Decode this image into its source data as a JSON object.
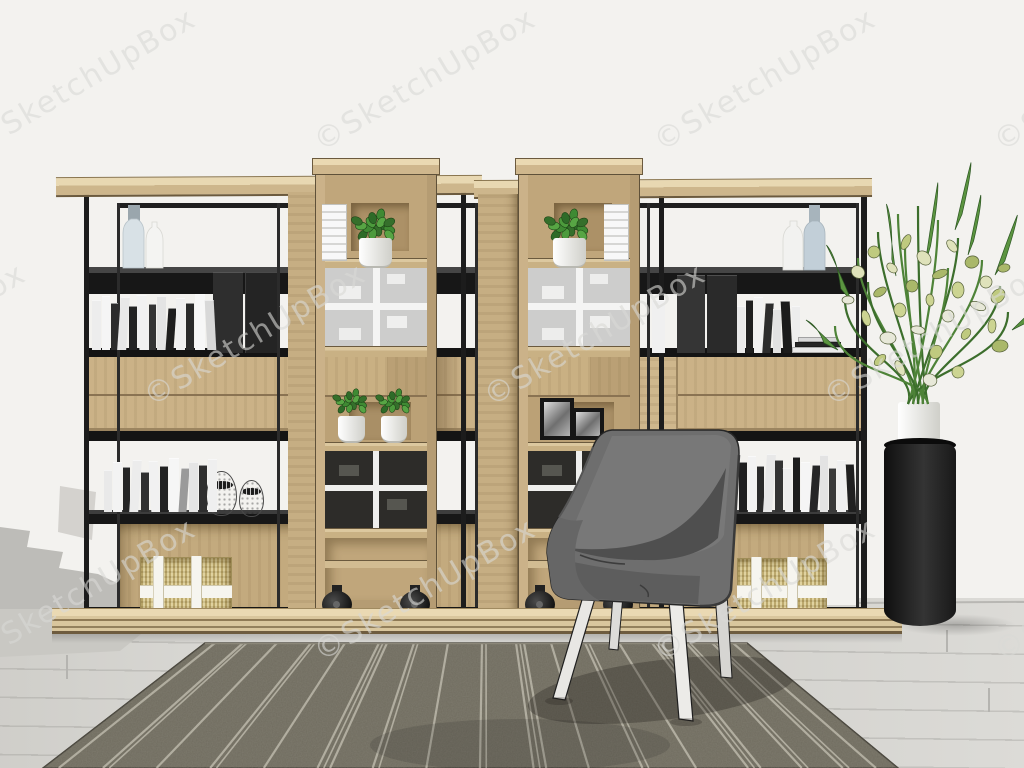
{
  "image_type": "3d-render-screenshot",
  "scene": {
    "description": "Modern home office corner: large open metal-and-wood shelving unit with two rolling wooden tower cabinets, grey fabric armchair, striped rug, flower arrangement on black pedestal",
    "objects": [
      "shelving-unit",
      "rolling-tower-left",
      "rolling-tower-right",
      "armchair",
      "striped-rug",
      "flower-pedestal",
      "books",
      "storage-baskets",
      "decor-vases",
      "potted-plants",
      "photo-frames",
      "egg-ornaments",
      "wood-floor",
      "white-wall"
    ]
  },
  "watermark": {
    "text": "©SketchUpBox",
    "angle_deg": -30.5,
    "font_size": 30,
    "rows": [
      {
        "y": 80,
        "xs": [
          85,
          425,
          765,
          1105
        ]
      },
      {
        "y": 335,
        "xs": [
          -85,
          255,
          595,
          935
        ]
      },
      {
        "y": 590,
        "xs": [
          85,
          425,
          765,
          1105
        ]
      }
    ]
  },
  "colors": {
    "wall": "#f3f2ef",
    "floor": "#dad9d5",
    "wood_light": "#cbb289",
    "wood_top": "#e8d8b4",
    "wood_dark": "#b59c73",
    "metal_frame": "#1c1c1c",
    "rug_base": "#6f6b5e",
    "rug_stripe": "#c9c5b6",
    "chair_fabric": "#6e6e6e",
    "pedestal": "#1a1a1a",
    "plant_green": "#4e8338",
    "blossom": "#dfe2bb",
    "basket_straw": "#d5c387"
  },
  "shelf": {
    "book_rows": [
      {
        "x": 92,
        "base": 350,
        "spines": [
          [
            9,
            50,
            "#ededed"
          ],
          [
            8,
            54,
            "#f5f5f5"
          ],
          [
            7,
            47,
            "#2b2b2b"
          ],
          [
            9,
            53,
            "#e8e8e8"
          ],
          [
            8,
            44,
            "#232323"
          ],
          [
            10,
            55,
            "#f1f1f1"
          ],
          [
            7,
            46,
            "#343434"
          ],
          [
            9,
            54,
            "#e4e4e4"
          ],
          [
            8,
            42,
            "#1e1e1e"
          ],
          [
            9,
            52,
            "#f0f0f0"
          ],
          [
            8,
            47,
            "#2a2a2a"
          ],
          [
            10,
            56,
            "#f7f7f7"
          ],
          [
            9,
            50,
            "#d8d8d8"
          ]
        ]
      },
      {
        "x": 652,
        "base": 353,
        "spines": [
          [
            13,
            53,
            "#f0f0f0"
          ]
        ]
      },
      {
        "x": 737,
        "base": 353,
        "spines": [
          [
            8,
            47,
            "#eaeaea"
          ],
          [
            7,
            53,
            "#202020"
          ],
          [
            9,
            56,
            "#f2f2f2"
          ],
          [
            8,
            50,
            "#2d2d2d"
          ],
          [
            8,
            44,
            "#e2e2e2"
          ],
          [
            9,
            52,
            "#1b1b1b"
          ],
          [
            8,
            47,
            "#ededed"
          ]
        ]
      },
      {
        "x": 104,
        "base": 512,
        "spines": [
          [
            8,
            42,
            "#e9e9e9"
          ],
          [
            9,
            50,
            "#f3f3f3"
          ],
          [
            7,
            45,
            "#262626"
          ],
          [
            9,
            52,
            "#ececec"
          ],
          [
            8,
            40,
            "#303030"
          ],
          [
            9,
            51,
            "#f1f1f1"
          ],
          [
            8,
            46,
            "#222222"
          ],
          [
            10,
            54,
            "#f6f6f6"
          ],
          [
            8,
            44,
            "#9a9a9a"
          ],
          [
            9,
            50,
            "#e5e5e5"
          ],
          [
            8,
            47,
            "#2e2e2e"
          ],
          [
            9,
            53,
            "#efefef"
          ]
        ]
      },
      {
        "x": 739,
        "base": 512,
        "spines": [
          [
            8,
            50,
            "#1f1f1f"
          ],
          [
            8,
            56,
            "#f2f2f2"
          ],
          [
            7,
            46,
            "#2a2a2a"
          ],
          [
            9,
            58,
            "#e8e8e8"
          ],
          [
            8,
            52,
            "#333333"
          ],
          [
            8,
            44,
            "#ededed"
          ],
          [
            7,
            55,
            "#1c1c1c"
          ],
          [
            9,
            50,
            "#f5f5f5"
          ],
          [
            8,
            47,
            "#262626"
          ],
          [
            8,
            57,
            "#e3e3e3"
          ],
          [
            7,
            44,
            "#3a3a3a"
          ],
          [
            9,
            52,
            "#f0f0f0"
          ],
          [
            8,
            48,
            "#202020"
          ]
        ]
      }
    ],
    "book_stacks": [
      {
        "x": 792,
        "y": 353,
        "slabs": [
          [
            52,
            6,
            "#e9e9e9"
          ],
          [
            46,
            5,
            "#262626"
          ],
          [
            40,
            5,
            "#d9d9d9"
          ]
        ]
      }
    ]
  },
  "rug": {
    "corners": [
      [
        205,
        643
      ],
      [
        747,
        643
      ],
      [
        898,
        768
      ],
      [
        43,
        768
      ]
    ],
    "stripes": [
      {
        "x": 215,
        "n": 1
      },
      {
        "x": 243,
        "n": 2
      },
      {
        "x": 277,
        "n": 1
      },
      {
        "x": 311,
        "n": 2
      },
      {
        "x": 345,
        "n": 1
      },
      {
        "x": 379,
        "n": 3
      },
      {
        "x": 414,
        "n": 2
      },
      {
        "x": 448,
        "n": 1
      },
      {
        "x": 482,
        "n": 2
      },
      {
        "x": 516,
        "n": 3
      },
      {
        "x": 551,
        "n": 1
      },
      {
        "x": 585,
        "n": 2
      },
      {
        "x": 619,
        "n": 1
      },
      {
        "x": 652,
        "n": 3
      },
      {
        "x": 686,
        "n": 2
      },
      {
        "x": 712,
        "n": 2
      },
      {
        "x": 733,
        "n": 1
      }
    ]
  }
}
